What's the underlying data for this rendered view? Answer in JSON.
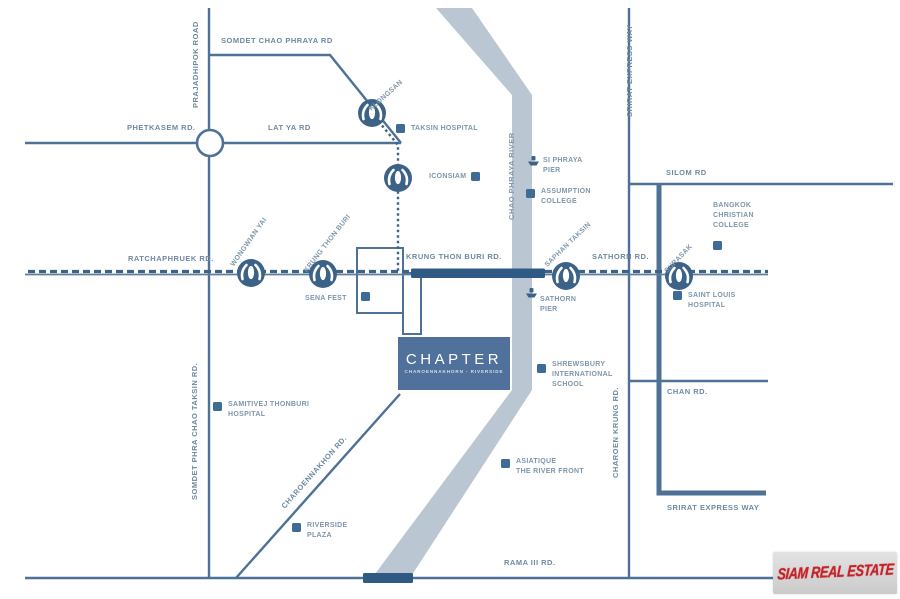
{
  "project": {
    "name": "CHAPTER",
    "subtitle": "CHAROENNAKHORN - RIVERSIDE"
  },
  "watermark": {
    "text": "SIAM REAL ESTATE"
  },
  "colors": {
    "road": "#4d7296",
    "river": "#bac6d1",
    "bridge": "#2e5a84",
    "bts_dash": "#3d6488",
    "marker": "#3f6b97",
    "label": "#7e96ab",
    "project_bg": "#50719b",
    "watermark_red": "#c4232a"
  },
  "labels": {
    "somdet_chao_phraya_rd": "SOMDET CHAO PHRAYA RD",
    "prajadhipok_road": "PRAJADHIPOK ROAD",
    "phetkasem_rd": "PHETKASEM RD.",
    "lat_ya_rd": "LAT YA RD",
    "klongsan": "KLONGSAN",
    "taksin_hospital": "TAKSIN HOSPITAL",
    "iconsiam": "ICONSIAM",
    "chao_phraya_river": "CHAO PHRAYA RIVER",
    "srirat_expressway_top": "SRIRAT EXPRESS WAY",
    "silom_rd": "SILOM RD",
    "si_phraya_pier": "SI PHRAYA\nPIER",
    "assumption_college": "ASSUMPTION\nCOLLEGE",
    "bangkok_christian_college": "BANGKOK\nCHRISTIAN\nCOLLEGE",
    "saphan_taksin": "SAPHAN TAKSIN",
    "surasak": "SURASAK",
    "sathorn_rd": "SATHORN RD.",
    "wongwian_yai": "WONGWIAN YAI",
    "krung_thon_buri": "KRUNG THON BURI",
    "ratchaphruek_rd": "RATCHAPHRUEK RD.",
    "krung_thon_buri_rd": "KRUNG THON BURI RD.",
    "sena_fest": "SENA FEST",
    "sathorn_pier": "SATHORN\nPIER",
    "saint_louis_hospital": "SAINT LOUIS\nHOSPITAL",
    "charoen_krung_rd": "CHAROEN KRUNG RD.",
    "chan_rd": "CHAN RD.",
    "shrewsbury": "SHREWSBURY\nINTERNATIONAL\nSCHOOL",
    "somdet_phra_chao_taksin_rd": "SOMDET PHRA CHAO TAKSIN RD.",
    "samitivej": "SAMITIVEJ THONBURI\nHOSPITAL",
    "charoennakhon_rd": "CHAROENNAKHON RD.",
    "asiatique": "ASIATIQUE\nTHE RIVER FRONT",
    "riverside_plaza": "RIVERSIDE\nPLAZA",
    "srirat_expressway_bottom": "SRIRAT EXPRESS WAY",
    "rama3_rd": "RAMA III RD."
  }
}
